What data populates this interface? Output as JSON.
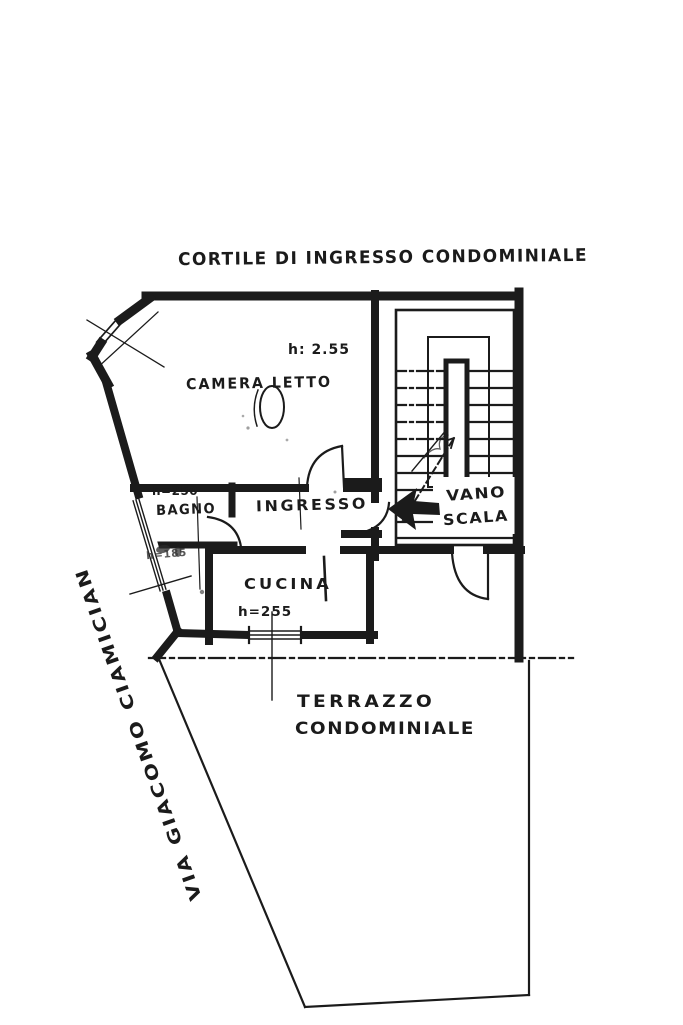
{
  "page": {
    "background": "#ffffff",
    "ink_color": "#1b1b1b",
    "drawing_type": "hand-drawn apartment floor plan (scan)"
  },
  "plan": {
    "courtyard_label": "CORTILE DI INGRESSO CONDOMINIALE",
    "street_label": "VIA GIACOMO CIAMICIAN",
    "terrace": {
      "line1": "TERRAZZO",
      "line2": "CONDOMINIALE"
    },
    "rooms": {
      "bedroom": {
        "name": "CAMERA LETTO",
        "height": "h: 2.55"
      },
      "bathroom": {
        "name": "BAGNO",
        "height": "h=250"
      },
      "hall": {
        "name": "INGRESSO"
      },
      "stairwell": {
        "name_line1": "VANO",
        "name_line2": "SCALA"
      },
      "kitchen": {
        "name": "CUCINA",
        "height": "h=255"
      },
      "niche": {
        "height": "h=185"
      }
    },
    "markers": {
      "entrance_arrow_direction": "left"
    }
  }
}
